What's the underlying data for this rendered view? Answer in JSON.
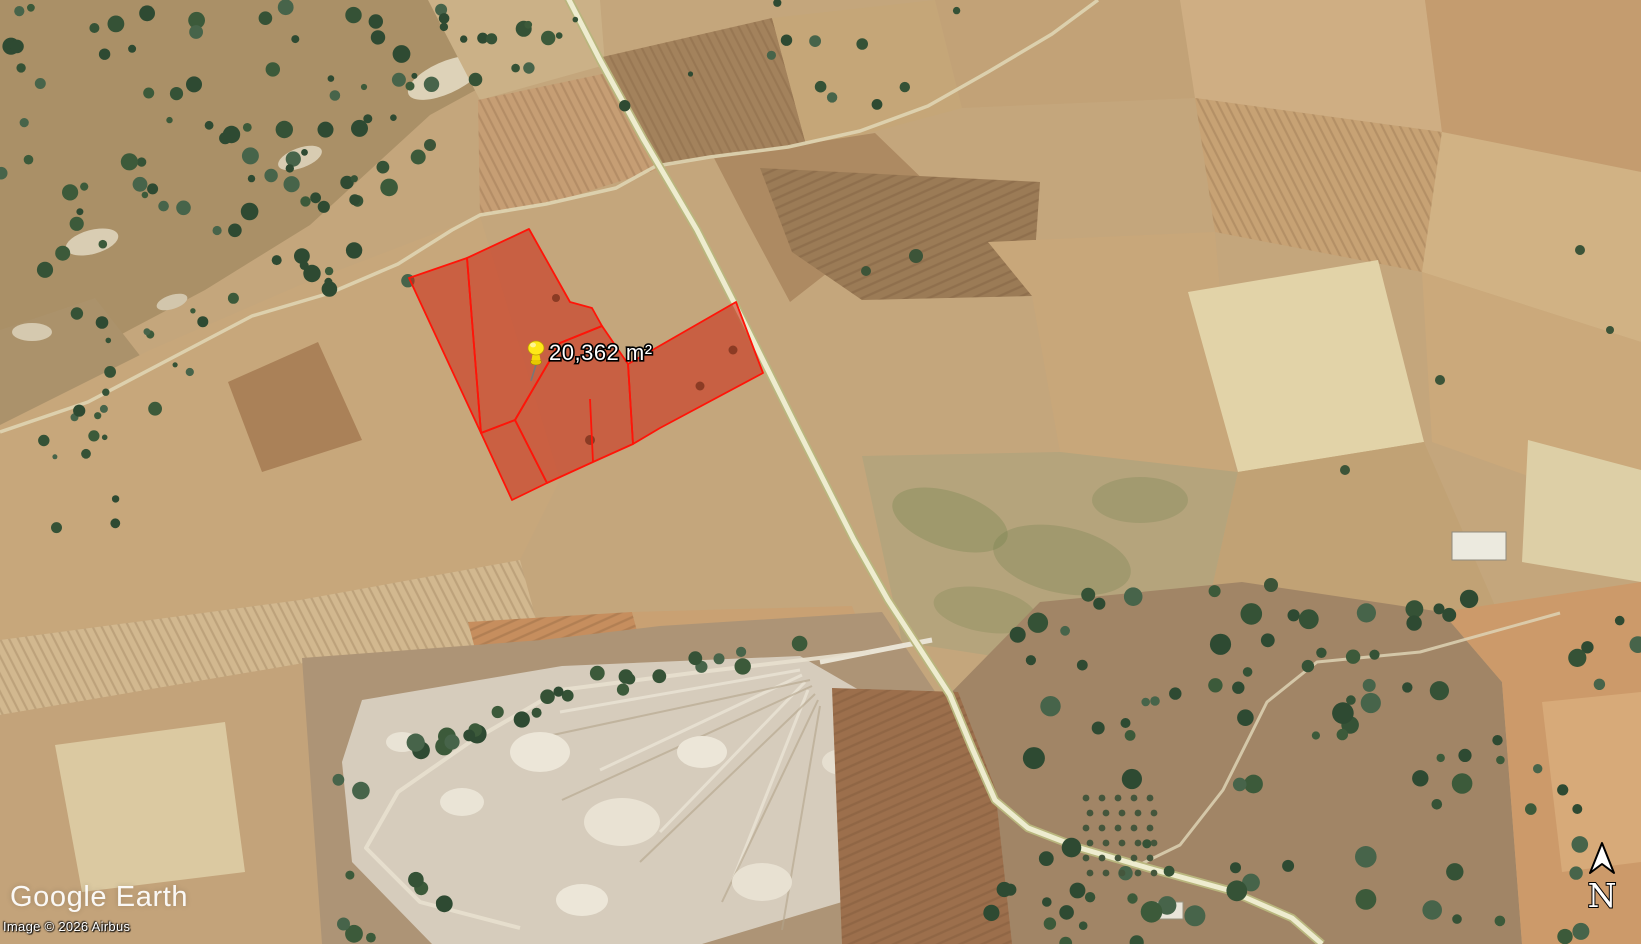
{
  "app": {
    "name": "Google Earth"
  },
  "map_overlay": {
    "parcel_label": "20,362 m²",
    "parcel_fill_color": "#cc2614",
    "parcel_border_color": "#ff1408",
    "pin_color": "#ffe818",
    "road_color": "#eeeccf"
  },
  "watermark": {
    "logo": "Google Earth",
    "copyright": "Image © 2026 Airbus"
  },
  "compass": {
    "north_label": "N"
  }
}
